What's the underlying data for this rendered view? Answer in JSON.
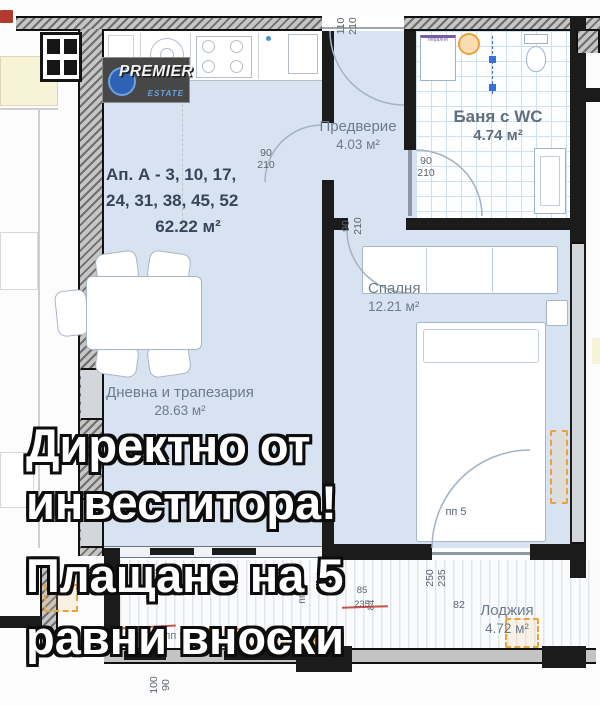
{
  "logo": {
    "name": "PREMIER",
    "sub": "ESTATE"
  },
  "overlay": {
    "line1": "Директно от",
    "line2": "инвеститора!",
    "line3": "Плащане на 5",
    "line4": "равни вноски"
  },
  "unit": {
    "title_line1": "Ап. А - 3, 10, 17,",
    "title_line2": "24, 31, 38, 45, 52",
    "area": "62.22 м²"
  },
  "rooms": {
    "hallway": {
      "name": "Предверие",
      "area": "4.03 м²"
    },
    "bath": {
      "name": "Баня с WC",
      "area": "4.74 м²"
    },
    "bedroom": {
      "name": "Спалня",
      "area": "12.21 м²"
    },
    "living": {
      "name": "Дневна и трапезария",
      "area": "28.63 м²"
    },
    "loggia": {
      "name": "Лоджия",
      "area": "4.72 м²"
    }
  },
  "dims": {
    "entry": "110\n210",
    "living_door": "90\n210",
    "bath_door": "90\n210",
    "bedroom_door": "90\n210",
    "loggia_door_bedroom": "250\n235",
    "loggia_door_bedroom_sill": "82",
    "loggia_door_living_w": "85",
    "loggia_door_living_h": "235",
    "loggia_door_living_sill": "84",
    "bottom_window": "100\n90",
    "door_tag_bedroom": "пп 5",
    "door_tag_living": "пп 5",
    "door_tag_main": "пп 50"
  },
  "bath": {
    "washer_label": "пералня"
  },
  "colors": {
    "floor": "#d7e3f0",
    "wall": "#1b1b1b",
    "accent_orange": "#e8a23f",
    "label": "#6c7b8b",
    "logo_blue": "#2f62b5"
  }
}
